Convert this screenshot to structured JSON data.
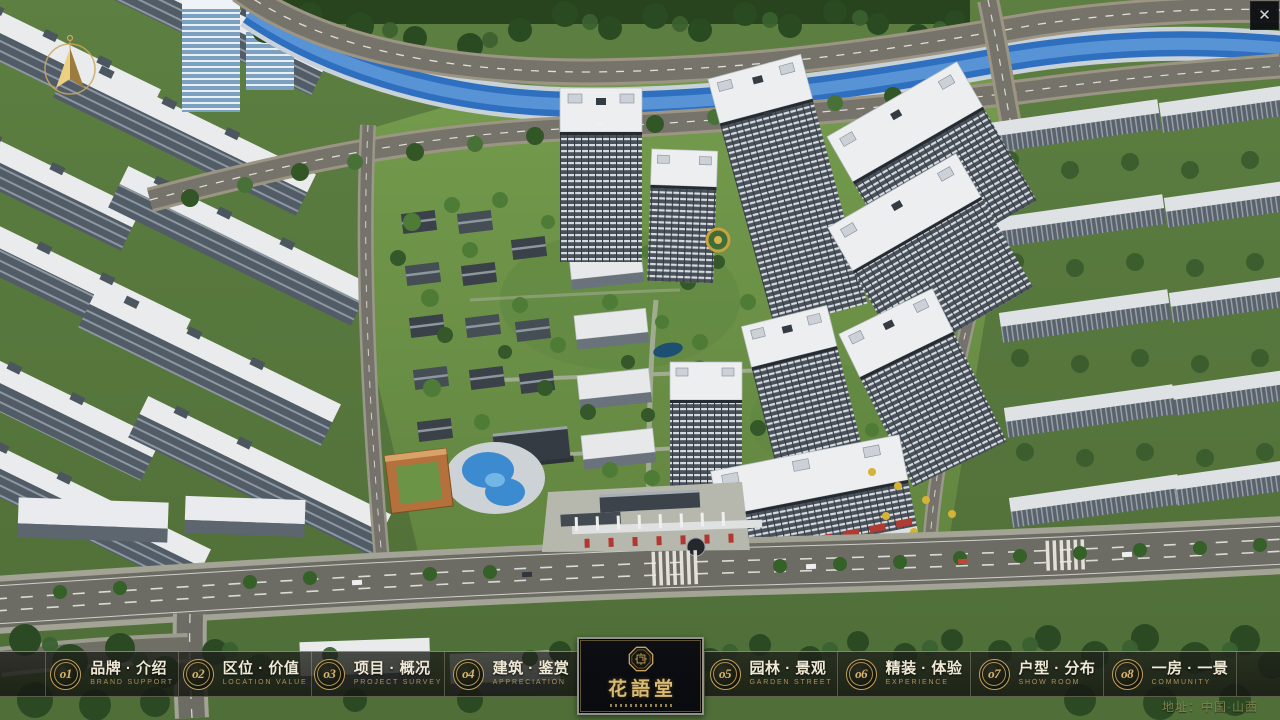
{
  "window": {
    "close_glyph": "✕"
  },
  "logo": {
    "title": "花語堂"
  },
  "nav": {
    "items": [
      {
        "num": "o1",
        "label": "品牌 · 介绍",
        "sub": "BRAND SUPPORT"
      },
      {
        "num": "o2",
        "label": "区位 · 价值",
        "sub": "LOCATION VALUE"
      },
      {
        "num": "o3",
        "label": "项目 · 概况",
        "sub": "PROJECT SURVEY"
      },
      {
        "num": "o4",
        "label": "建筑 · 鉴赏",
        "sub": "APPRECIATION"
      },
      {
        "num": "o5",
        "label": "园林 · 景观",
        "sub": "GARDEN STREET"
      },
      {
        "num": "o6",
        "label": "精装 · 体验",
        "sub": "EXPERIENCE"
      },
      {
        "num": "o7",
        "label": "户型 · 分布",
        "sub": "SHOW ROOM"
      },
      {
        "num": "o8",
        "label": "一房 · 一景",
        "sub": "COMMUNITY"
      }
    ]
  },
  "footer": {
    "address": "地址：中国·山西"
  }
}
